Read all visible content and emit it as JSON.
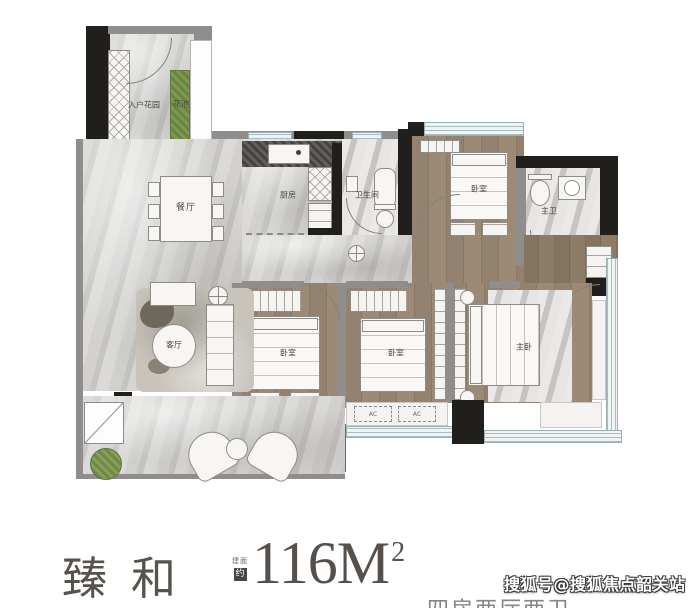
{
  "meta": {
    "type": "apartment-floor-plan"
  },
  "plan": {
    "labels": {
      "entry_garden": "入户花园",
      "flower_bed_top": "花池",
      "dining": "餐厅",
      "kitchen": "厨房",
      "bathroom": "卫生间",
      "bedroom_top": "卧室",
      "master_bath": "主卫",
      "living": "客厅",
      "bedroom_mid": "卧室",
      "bedroom_right": "卧室",
      "master_bedroom": "主卧",
      "flower_bed_bottom": "花池",
      "ac_unit_1": "AC",
      "ac_unit_2": "AC"
    },
    "colors": {
      "wood": "#93826f",
      "marble": "#d2d1cf",
      "wall": "#211f1c",
      "planter_green": "#7d9a4f",
      "window": "#a9bcc0"
    }
  },
  "footer": {
    "project_name": "臻和",
    "area_prefix_line1": "建面",
    "area_prefix_line2": "约",
    "area_value": "116M",
    "area_superscript": "2",
    "layout_type": "四房两厅两卫"
  },
  "watermark": {
    "text": "搜狐号@搜狐焦点韶关站"
  }
}
